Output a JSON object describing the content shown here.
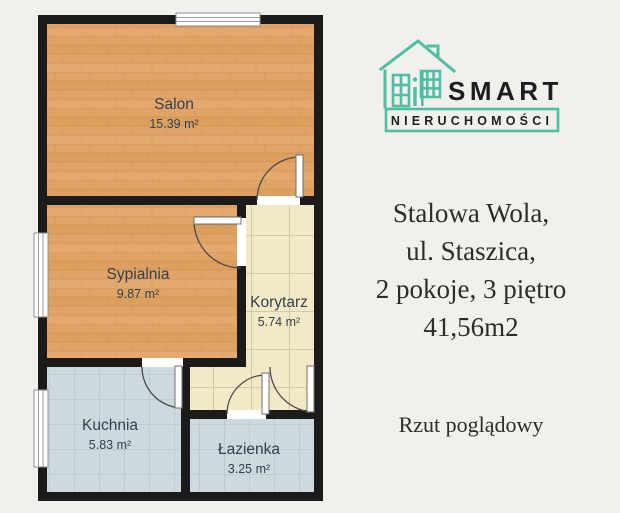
{
  "logo": {
    "monogram": "BiP",
    "brand_top": "SMART",
    "brand_bottom": "NIERUCHOMOŚCI",
    "accent_color": "#50bea5"
  },
  "listing": {
    "lines": {
      "0": "Stalowa Wola,",
      "1": "ul. Staszica,",
      "2": "2 pokoje, 3 piętro",
      "3": "41,56m2"
    },
    "caption": "Rzut poglądowy"
  },
  "floor_plan": {
    "rooms": {
      "salon": {
        "name": "Salon",
        "area": "15.39 m²"
      },
      "sypialnia": {
        "name": "Sypialnia",
        "area": "9.87 m²"
      },
      "korytarz": {
        "name": "Korytarz",
        "area": "5.74 m²"
      },
      "kuchnia": {
        "name": "Kuchnia",
        "area": "5.83 m²"
      },
      "lazienka": {
        "name": "Łazienka",
        "area": "3.25 m²"
      }
    },
    "features": [
      "window-top",
      "window-left-bedroom",
      "window-left-kitchen",
      "door-salon",
      "door-bedroom",
      "door-kitchen",
      "door-bathroom",
      "door-entry"
    ]
  },
  "colors": {
    "background": "#f2f0ec",
    "walls": "#1b1b1b",
    "wood_floor": "#e1a466",
    "corridor_tile": "#f3e9c6",
    "wet_room_tile": "#ced8df",
    "label_text": "#32404e",
    "serif_text": "#2e2c29",
    "logo_accent": "#50bea5"
  }
}
